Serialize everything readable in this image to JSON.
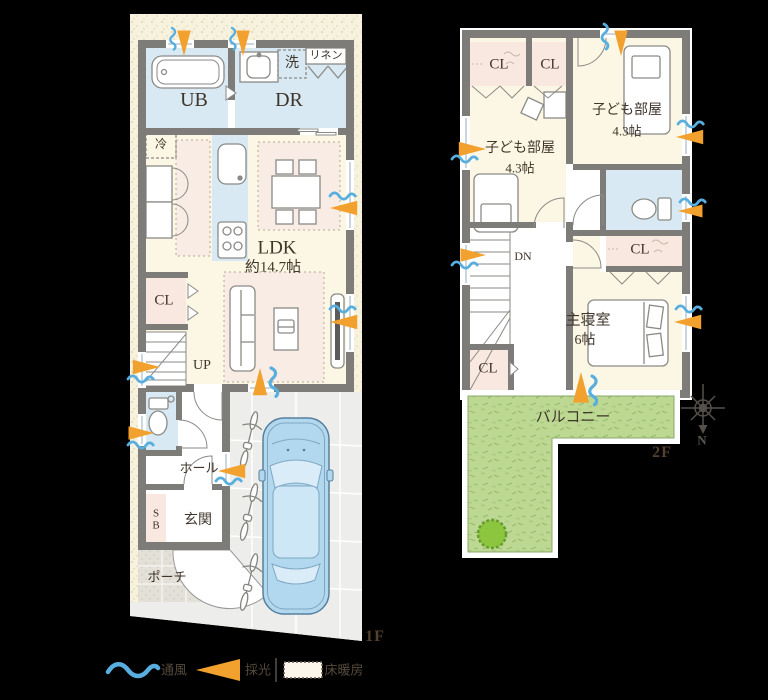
{
  "title": "住宅間取り図 1F・2F",
  "colors": {
    "background": "#000000",
    "site_cream": "#f7f2de",
    "wall_gray": "#7d7c78",
    "wet_room_blue": "#d8e9f3",
    "room_cream": "#fcf7e5",
    "closet_pink": "#f9e8df",
    "floor_heating_pink": "#f8ece5",
    "balcony_green": "#bcd893",
    "parking_gray": "#ededeb",
    "vent_blue": "#58aede",
    "daylight_orange": "#f2a12e",
    "car_blue": "#b2d8f0",
    "text_brown": "#3f352b"
  },
  "floor1": {
    "label": "1F",
    "rooms": {
      "ub": "UB",
      "dr": "DR",
      "wash": "洗",
      "linen": "リネン",
      "fridge": "冷",
      "ldk_name": "LDK",
      "ldk_size": "約14.7帖",
      "closet": "CL",
      "stairs": "UP",
      "hall": "ホール",
      "shoe_box": "SB",
      "entrance": "玄関",
      "porch": "ポーチ"
    }
  },
  "floor2": {
    "label": "2F",
    "rooms": {
      "closet1": "CL",
      "closet2": "CL",
      "kids_room1_name": "子ども部屋",
      "kids_room1_size": "4.3帖",
      "kids_room2_name": "子ども部屋",
      "kids_room2_size": "4.3帖",
      "stairs": "DN",
      "closet3": "CL",
      "master_name": "主寝室",
      "master_size": "6帖",
      "closet4": "CL",
      "balcony": "バルコニー"
    }
  },
  "compass": {
    "north": "N"
  },
  "legend": {
    "ventilation": "通風",
    "daylight": "採光",
    "floor_heating": "床暖房"
  }
}
